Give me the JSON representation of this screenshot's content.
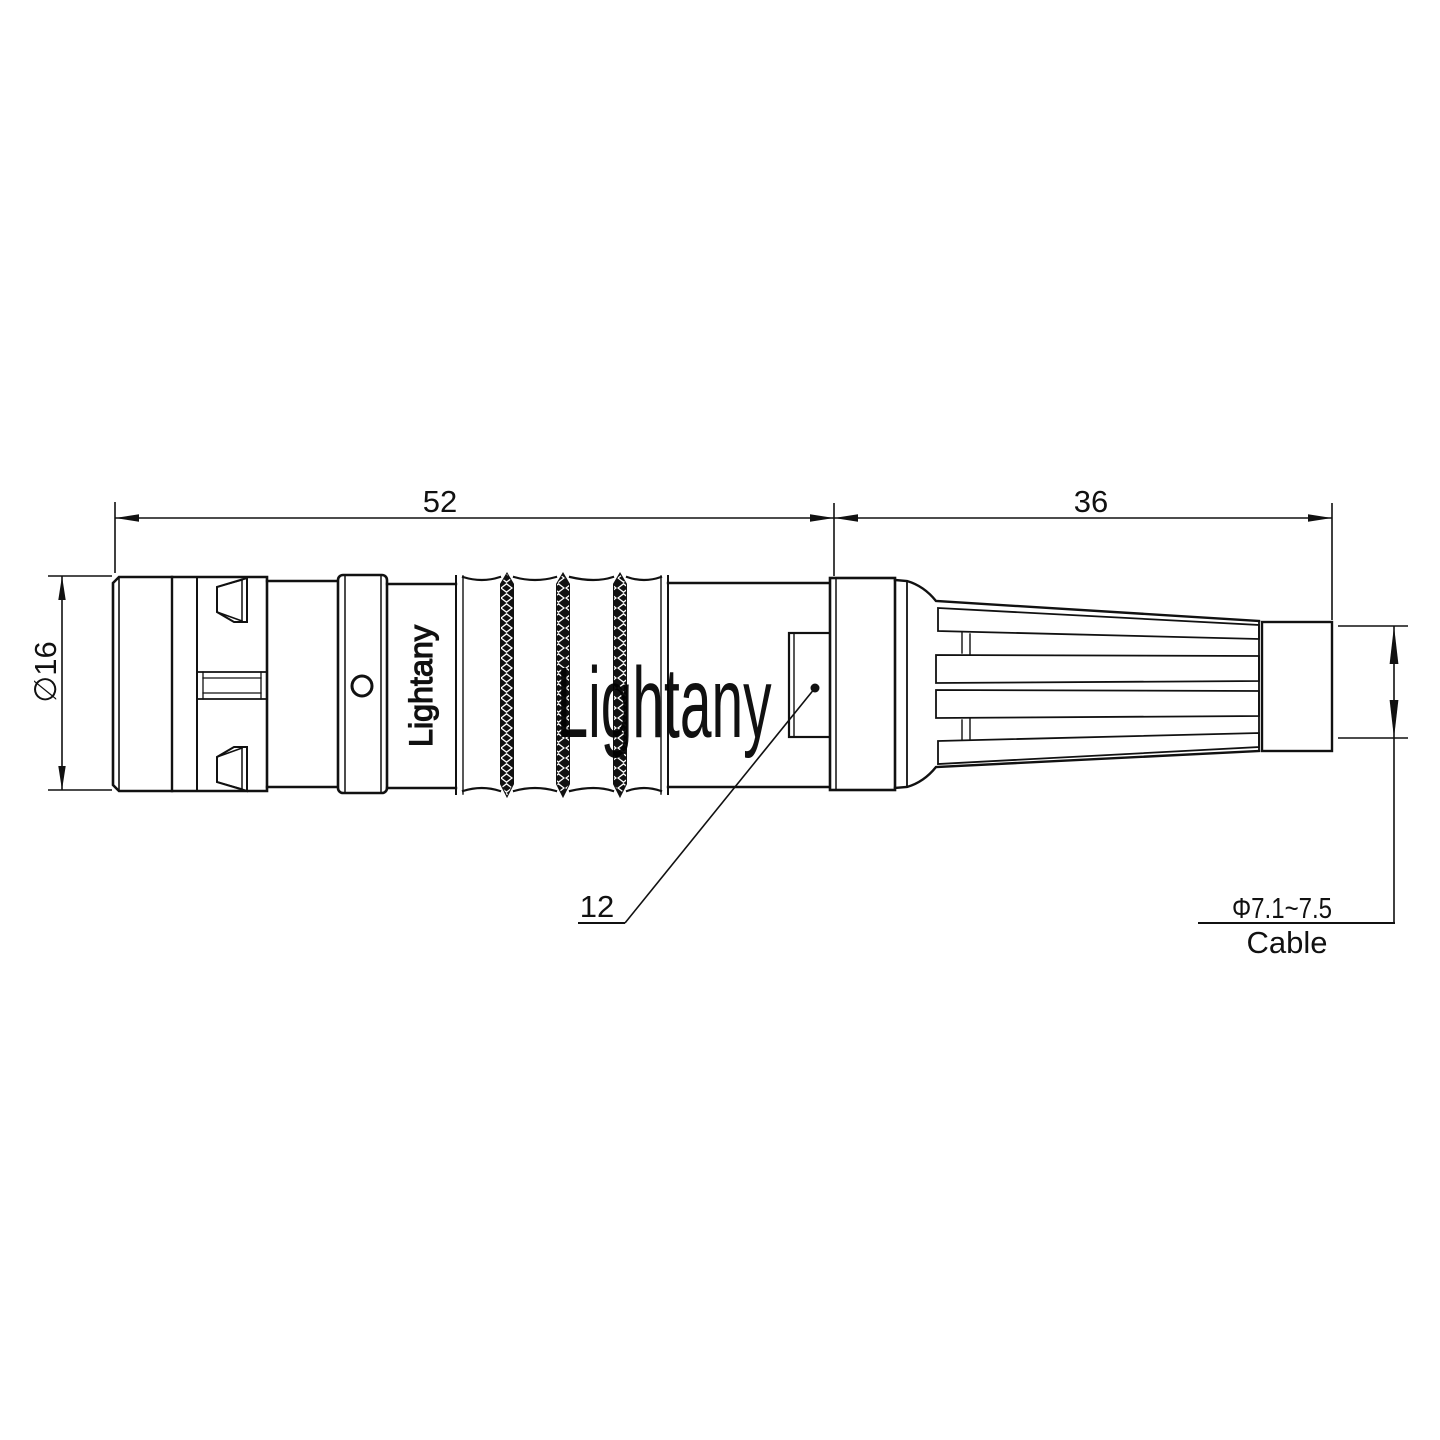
{
  "drawing": {
    "title_note": "",
    "dimensions": {
      "front_length": "52",
      "rear_length": "36",
      "body_diameter": "∅16",
      "key_size": "12",
      "cable_diameter": "Φ7.1~7.5",
      "cable_label": "Cable"
    },
    "branding": {
      "engraved_text": "Lightany",
      "watermark_text": "Lightany"
    },
    "colors": {
      "line": "#111111",
      "background": "#ffffff",
      "watermark": "#f6cdcd"
    }
  }
}
